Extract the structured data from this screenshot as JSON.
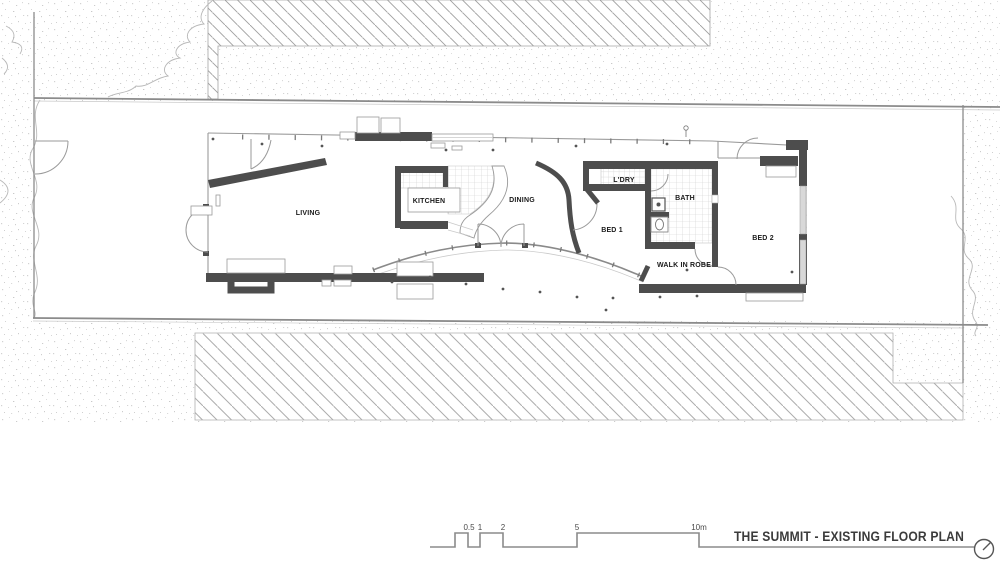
{
  "title_block": {
    "title": "THE SUMMIT - EXISTING FLOOR PLAN",
    "north_indicator_icon": "compass-circle"
  },
  "rooms": {
    "living": "LIVING",
    "kitchen": "KITCHEN",
    "dining": "DINING",
    "laundry": "L'DRY",
    "bed1": "BED 1",
    "bath": "BATH",
    "bed2": "BED 2",
    "walk_in_robe": "WALK IN ROBE"
  },
  "scale_bar": {
    "unit_labels": [
      "0.5",
      "1",
      "2",
      "5",
      "10m"
    ]
  },
  "colors": {
    "wall": "#4d4d4d",
    "thin_line": "#9a9a9a",
    "site_line": "#8b8b8b",
    "hatch": "#9e9e9e",
    "tile_grid": "#cfcfcf",
    "window_fill": "#d8d8d8",
    "label_text": "#1a1a1a",
    "title_text": "#3b3b3b"
  }
}
